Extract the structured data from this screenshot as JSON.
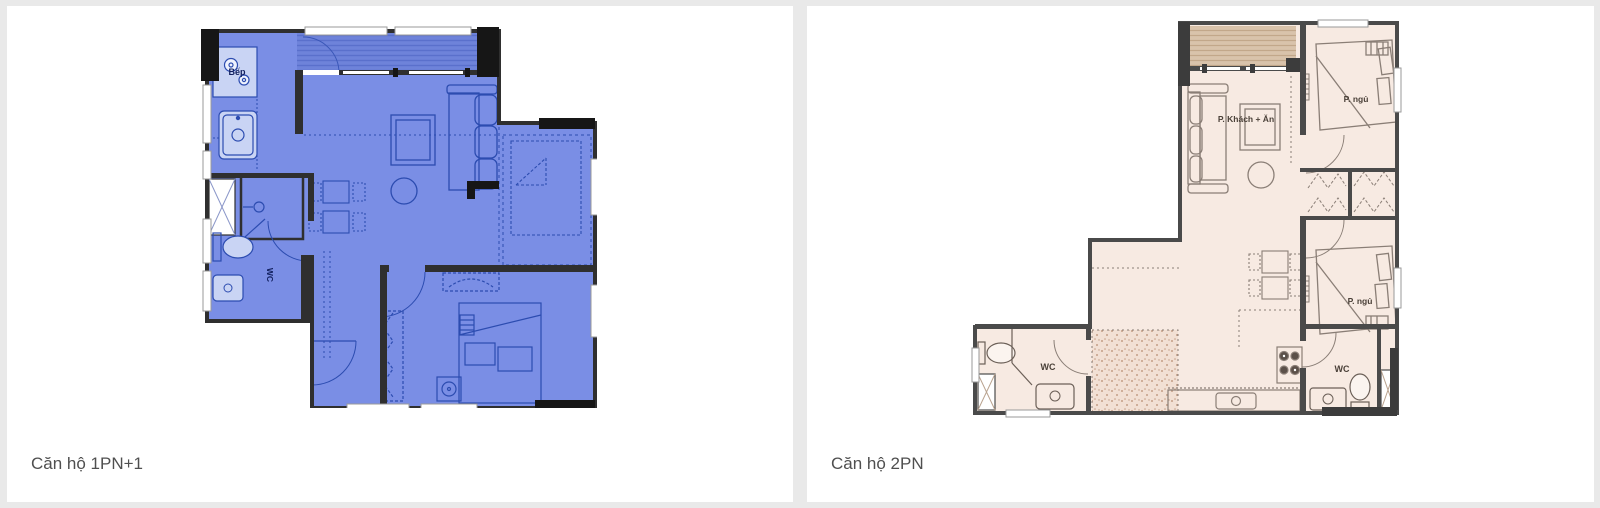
{
  "page": {
    "background_color": "#e9e9e9",
    "card_background_color": "#ffffff",
    "caption_text_color": "#4f4f4f"
  },
  "cards": [
    {
      "caption": "Căn hộ 1PN+1",
      "plan": {
        "type": "floorplan",
        "unit_type": "1 bedroom + 1",
        "fill": "#7a8ee5",
        "balcony_fill": "#6e83da",
        "line_color": "#2c4cb0",
        "wall_color": "#2f2f2f",
        "labels": {
          "kitchen": "Bếp",
          "wc": "WC"
        }
      }
    },
    {
      "caption": "Căn hộ 2PN",
      "plan": {
        "type": "floorplan",
        "unit_type": "2 bedrooms",
        "fill": "#f7eae2",
        "balcony_fill": "#d9c3ab",
        "line_color": "#8a7e76",
        "wall_color": "#4a4a4a",
        "labels": {
          "living_dining": "P. Khách + Ăn",
          "bedroom_1": "P. ngủ",
          "bedroom_2": "P. ngủ",
          "wc_1": "WC",
          "wc_2": "WC"
        }
      }
    }
  ]
}
